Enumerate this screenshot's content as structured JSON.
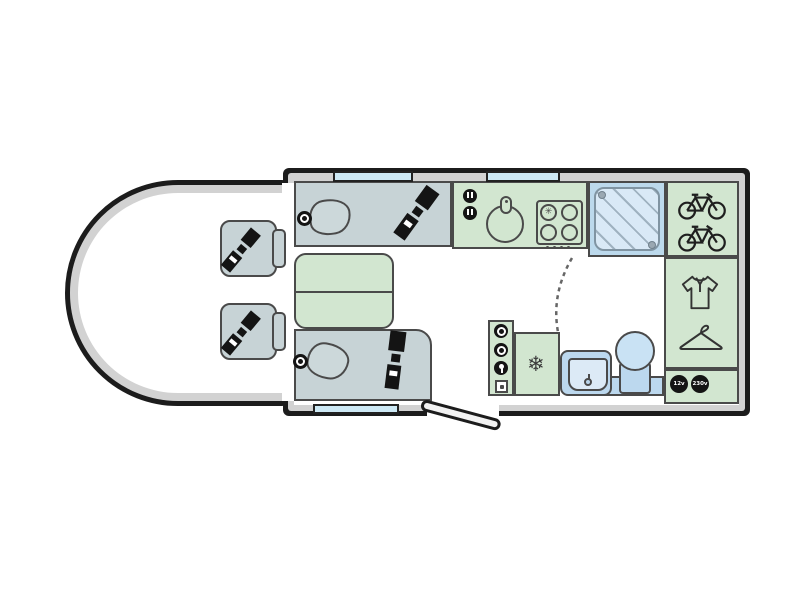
{
  "floorplan": {
    "vehicle": "motorhome",
    "view": "top-down floor plan",
    "labels": {
      "socket_12v": "12v",
      "socket_230v": "230v"
    },
    "glyphs": {
      "fridge_snowflake": "❄",
      "hob_burner_flame": "✳"
    },
    "colors": {
      "wall": "#1c1c1c",
      "wall_inner_band": "#d2d2d2",
      "floor": "#ffffff",
      "upholstery_grey_blue": "#c7d3d6",
      "furniture_green": "#d2e6d0",
      "window_blue": "#cde9f5",
      "shower_blue": "#bcd9ec",
      "shower_tray": "#d9e9f6",
      "sanitary_blue": "#bcd8ee",
      "outline": "#4a4a4a",
      "seatbelt_black": "#141414"
    },
    "features": [
      {
        "id": "cab",
        "desc": "driver cab with two swivel seats fitted with seatbelts"
      },
      {
        "id": "front-lounge",
        "desc": "two facing bench seats with pillows, seatbelts, speakers and central table"
      },
      {
        "id": "kitchen",
        "desc": "kitchen with round sink, tap, four-burner hob and sockets"
      },
      {
        "id": "shower",
        "desc": "separate shower cubicle"
      },
      {
        "id": "bike-garage",
        "desc": "rear storage for two bicycles"
      },
      {
        "id": "wardrobe",
        "desc": "wardrobe with shirt and hanger symbols"
      },
      {
        "id": "washroom",
        "desc": "washroom with basin, vanity counter and toilet behind tambour door"
      },
      {
        "id": "fridge",
        "desc": "refrigerator marked with snowflake"
      },
      {
        "id": "entry-door",
        "desc": "habitation entry door shown open"
      },
      {
        "id": "power",
        "desc": "12v and 230v power points"
      }
    ]
  }
}
